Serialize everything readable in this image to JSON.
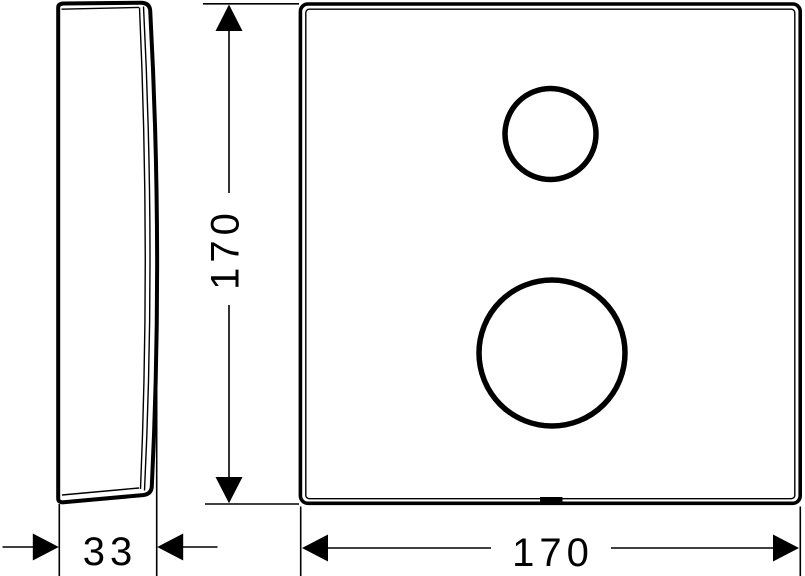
{
  "drawing": {
    "type": "technical-dimension-drawing",
    "views": [
      "side-profile",
      "front-plate"
    ],
    "colors": {
      "line": "#000000",
      "background": "#ffffff"
    }
  },
  "dimensions": {
    "height": "170",
    "width": "170",
    "depth": "33"
  }
}
